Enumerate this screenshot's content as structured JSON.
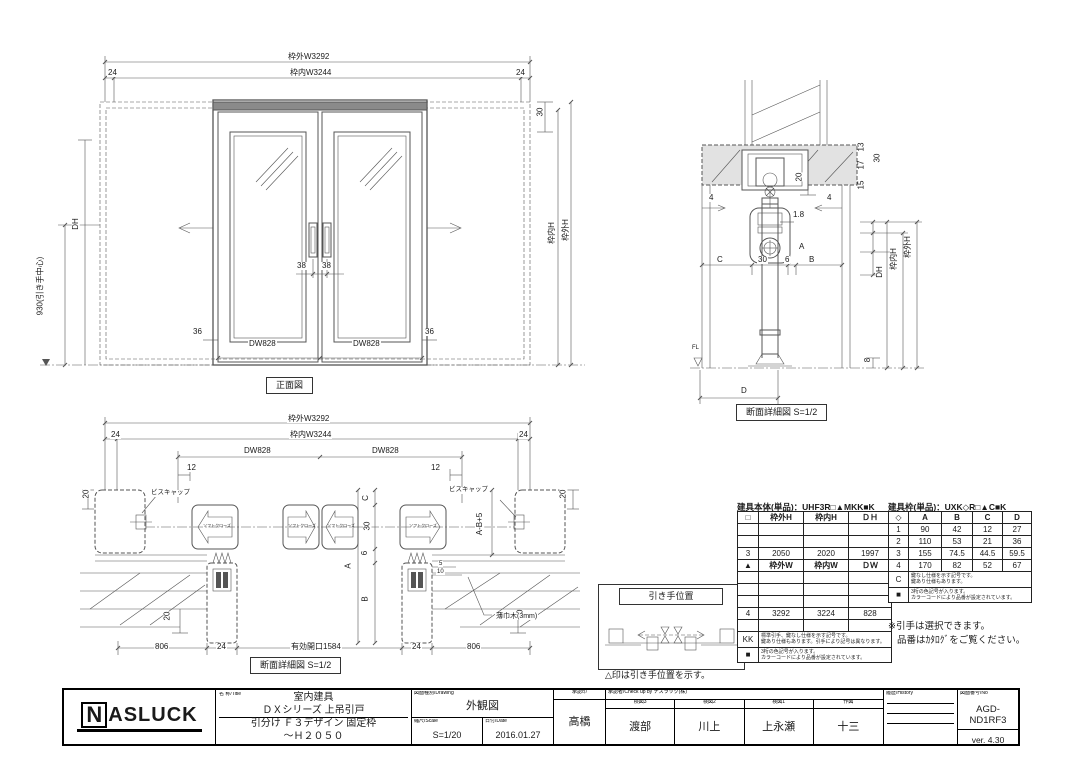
{
  "front_view": {
    "caption": "正面図",
    "door_code": "DW828",
    "dims": {
      "outer_w": "枠外W3292",
      "inner_w": "枠内W3244",
      "end_24": "24",
      "top_30": "30",
      "dh": "DH",
      "handle_center": "930(引き手中心)",
      "stile_36": "36",
      "gap_38": "38",
      "inner_h": "枠内H",
      "outer_h": "枠外H"
    }
  },
  "section_view": {
    "caption": "断面詳細図 S=1/2",
    "floor_label": "FL",
    "dims": {
      "d13": "13",
      "d17": "17",
      "d15": "15",
      "d30": "30",
      "d20": "20",
      "clearance": "1.8",
      "d4": "4",
      "a": "A",
      "c": "C",
      "c30": "30",
      "d6": "6",
      "b": "B",
      "dh": "DH",
      "inner_h": "枠内H",
      "outer_h": "枠外H",
      "d8": "8",
      "d": "D"
    }
  },
  "plan_view": {
    "caption": "断面詳細図 S=1/2",
    "labels": {
      "screw_cap": "ビスキャップ",
      "soft_close": "ソフトクローズ",
      "baseboard": "薄巾木(3mm)"
    },
    "dims": {
      "outer_w": "枠外W3292",
      "inner_w": "枠内W3244",
      "end_24": "24",
      "door_code": "DW828",
      "d12": "12",
      "d20": "20",
      "c": "C",
      "c30": "30",
      "d6": "6",
      "a": "A",
      "b": "B",
      "a_b5": "A-B+5",
      "d5": "5",
      "d10": "10",
      "d806": "806",
      "d24": "24",
      "opening": "有効開口1584"
    }
  },
  "handle_position": {
    "title": "引き手位置",
    "note": "△印は引き手位置を示す。"
  },
  "tables": {
    "body": {
      "title": "建具本体(単品)：UHF3R□▲MKK■K",
      "headers": [
        "□",
        "枠外H",
        "枠内H",
        "ＤＨ"
      ],
      "rows": [
        [
          "",
          "",
          "",
          ""
        ],
        [
          "",
          "",
          "",
          ""
        ],
        [
          "3",
          "2050",
          "2020",
          "1997"
        ],
        [
          "▲",
          "枠外W",
          "枠内W",
          "ＤＷ"
        ],
        [
          "",
          "",
          "",
          ""
        ],
        [
          "",
          "",
          "",
          ""
        ],
        [
          "",
          "",
          "",
          ""
        ],
        [
          "4",
          "3292",
          "3224",
          "828"
        ],
        [
          "",
          "",
          "",
          ""
        ]
      ],
      "notes": [
        {
          "label": "KK",
          "line1": "標準引手、鍵なし仕様を示す記号です。",
          "line2": "鍵あり仕様もあります。引手により記号は異なります。"
        },
        {
          "label": "■",
          "line1": "3桁の色記号が入ります。",
          "line2": "カラーコードにより品番が設定されています。"
        }
      ]
    },
    "frame": {
      "title": "建具枠(単品)：UXK◇R□▲C■K",
      "headers": [
        "◇",
        "A",
        "B",
        "C",
        "D"
      ],
      "rows": [
        [
          "1",
          "90",
          "42",
          "12",
          "27"
        ],
        [
          "2",
          "110",
          "53",
          "21",
          "36"
        ],
        [
          "3",
          "155",
          "74.5",
          "44.5",
          "59.5"
        ],
        [
          "4",
          "170",
          "82",
          "52",
          "67"
        ]
      ],
      "notes": [
        {
          "label": "C",
          "line1": "鍵なし仕様を示す記号です。",
          "line2": "鍵あり仕様もあります。"
        },
        {
          "label": "■",
          "line1": "3桁の色記号が入ります。",
          "line2": "カラーコードにより品番が設定されています。"
        }
      ]
    }
  },
  "notes": {
    "line1": "※引手は選択できます。",
    "line2": "品番はｶﾀﾛｸﾞをご覧ください。"
  },
  "title_block": {
    "logo": "ASLUCK",
    "logo_initial": "N",
    "name": {
      "label": "名 称/Title",
      "line1": "室内建具",
      "line2": "ＤＸシリーズ 上吊引戸",
      "line3": "引分け Ｆ３デザイン 固定枠",
      "line4": "～Ｈ２０５０"
    },
    "drawing": {
      "label": "図面種別/Drawing",
      "value": "外観図",
      "scale_label": "縮尺/Scale",
      "scale": "S=1/20",
      "date_label": "日付/Date",
      "date": "2016.01.27"
    },
    "approval": {
      "label": "承認印",
      "name": "高橋"
    },
    "check": {
      "label": "承認者/Check up by ナスラック(株)",
      "cols": [
        {
          "label": "検図3",
          "name": "渡部"
        },
        {
          "label": "検図2",
          "name": "川上"
        },
        {
          "label": "検図1",
          "name": "上永瀬"
        },
        {
          "label": "作図",
          "name": "十三"
        }
      ]
    },
    "history": {
      "label": "履歴/History"
    },
    "number": {
      "label": "図面番号/No",
      "value": "AGD-ND1RF3",
      "version": "ver. 4.30"
    }
  }
}
